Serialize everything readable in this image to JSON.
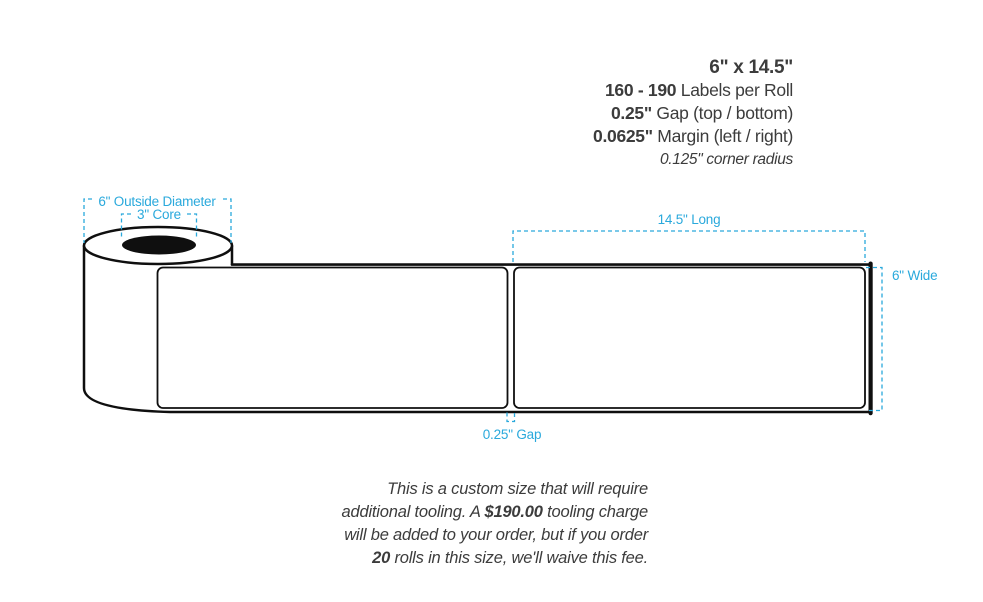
{
  "specs": {
    "size": "6\" x 14.5\"",
    "labels_per_roll_value": "160 - 190",
    "labels_per_roll_label": " Labels per Roll",
    "gap_value": "0.25\"",
    "gap_label": " Gap (top / bottom)",
    "margin_value": "0.0625\"",
    "margin_label": " Margin (left / right)",
    "corner_radius": "0.125\" corner radius"
  },
  "diagram": {
    "outside_diameter_label": "6\" Outside Diameter",
    "core_label": "3\" Core",
    "long_label": "14.5\" Long",
    "wide_label": "6\" Wide",
    "gap_label": "0.25\" Gap",
    "annotation_color": "#2aa9dc",
    "line_color": "#0f0f0f",
    "label_fill": "#ffffff"
  },
  "note": {
    "part1": "This is a custom size that will require additional tooling. A ",
    "tooling_charge": "$190.00",
    "part2": " tooling charge will be added to your order, but if you order ",
    "rolls_count": "20",
    "part3": " rolls in this size, we'll waive this fee."
  }
}
